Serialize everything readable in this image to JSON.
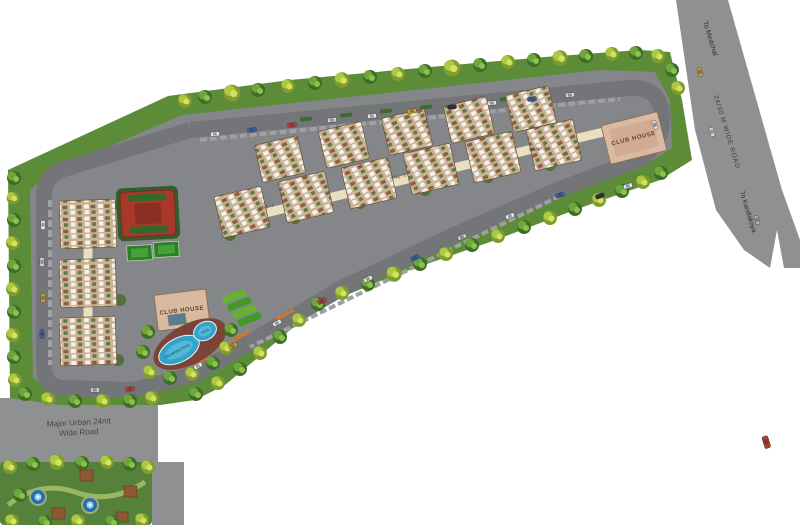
{
  "labels": {
    "to_medchal": "To Medchal",
    "wide_road": "24/30 M WIDE ROAD",
    "to_kandlakoya": "To Kandlakoya",
    "major_urban_road_line1": "Major Urban 24mt",
    "major_urban_road_line2": "Wide Road",
    "club_house_main": "CLUB HOUSE",
    "club_house_amenity": "CLUB HOUSE",
    "swimming_pool": "SWIMMING POOL",
    "pool": "POOL",
    "wing1": "Wing - 1",
    "wing2": "Wing - 2",
    "wing3": "Wing - 3"
  },
  "palette": {
    "site_green": "#5d8c39",
    "tree_dark": "#3e6e26",
    "tree_light": "#8cc14f",
    "tree_bright": "#c6d955",
    "paved_gray": "#85868a",
    "road_gray": "#747578",
    "highway_gray": "#8f9092",
    "building_tan": "#c9b394",
    "clubhouse_tan": "#d9b9a0",
    "spine_cream": "#eadfbf",
    "pool_blue": "#35a3c9",
    "court_red": "#a8392a",
    "court_green": "#2e7d28",
    "amenity_court_green": "#63b52f",
    "park_green": "#55813a",
    "walkway_orange": "#d07828"
  },
  "features": [
    "greenbelt-trees",
    "internal-loop-road",
    "apartment-wings",
    "central-spine",
    "tennis-court",
    "basketball-courts",
    "club-house",
    "swimming-pool",
    "kids-pool",
    "amenity-courts",
    "landscaped-park",
    "water-fountain",
    "pergola",
    "highway",
    "cars"
  ]
}
